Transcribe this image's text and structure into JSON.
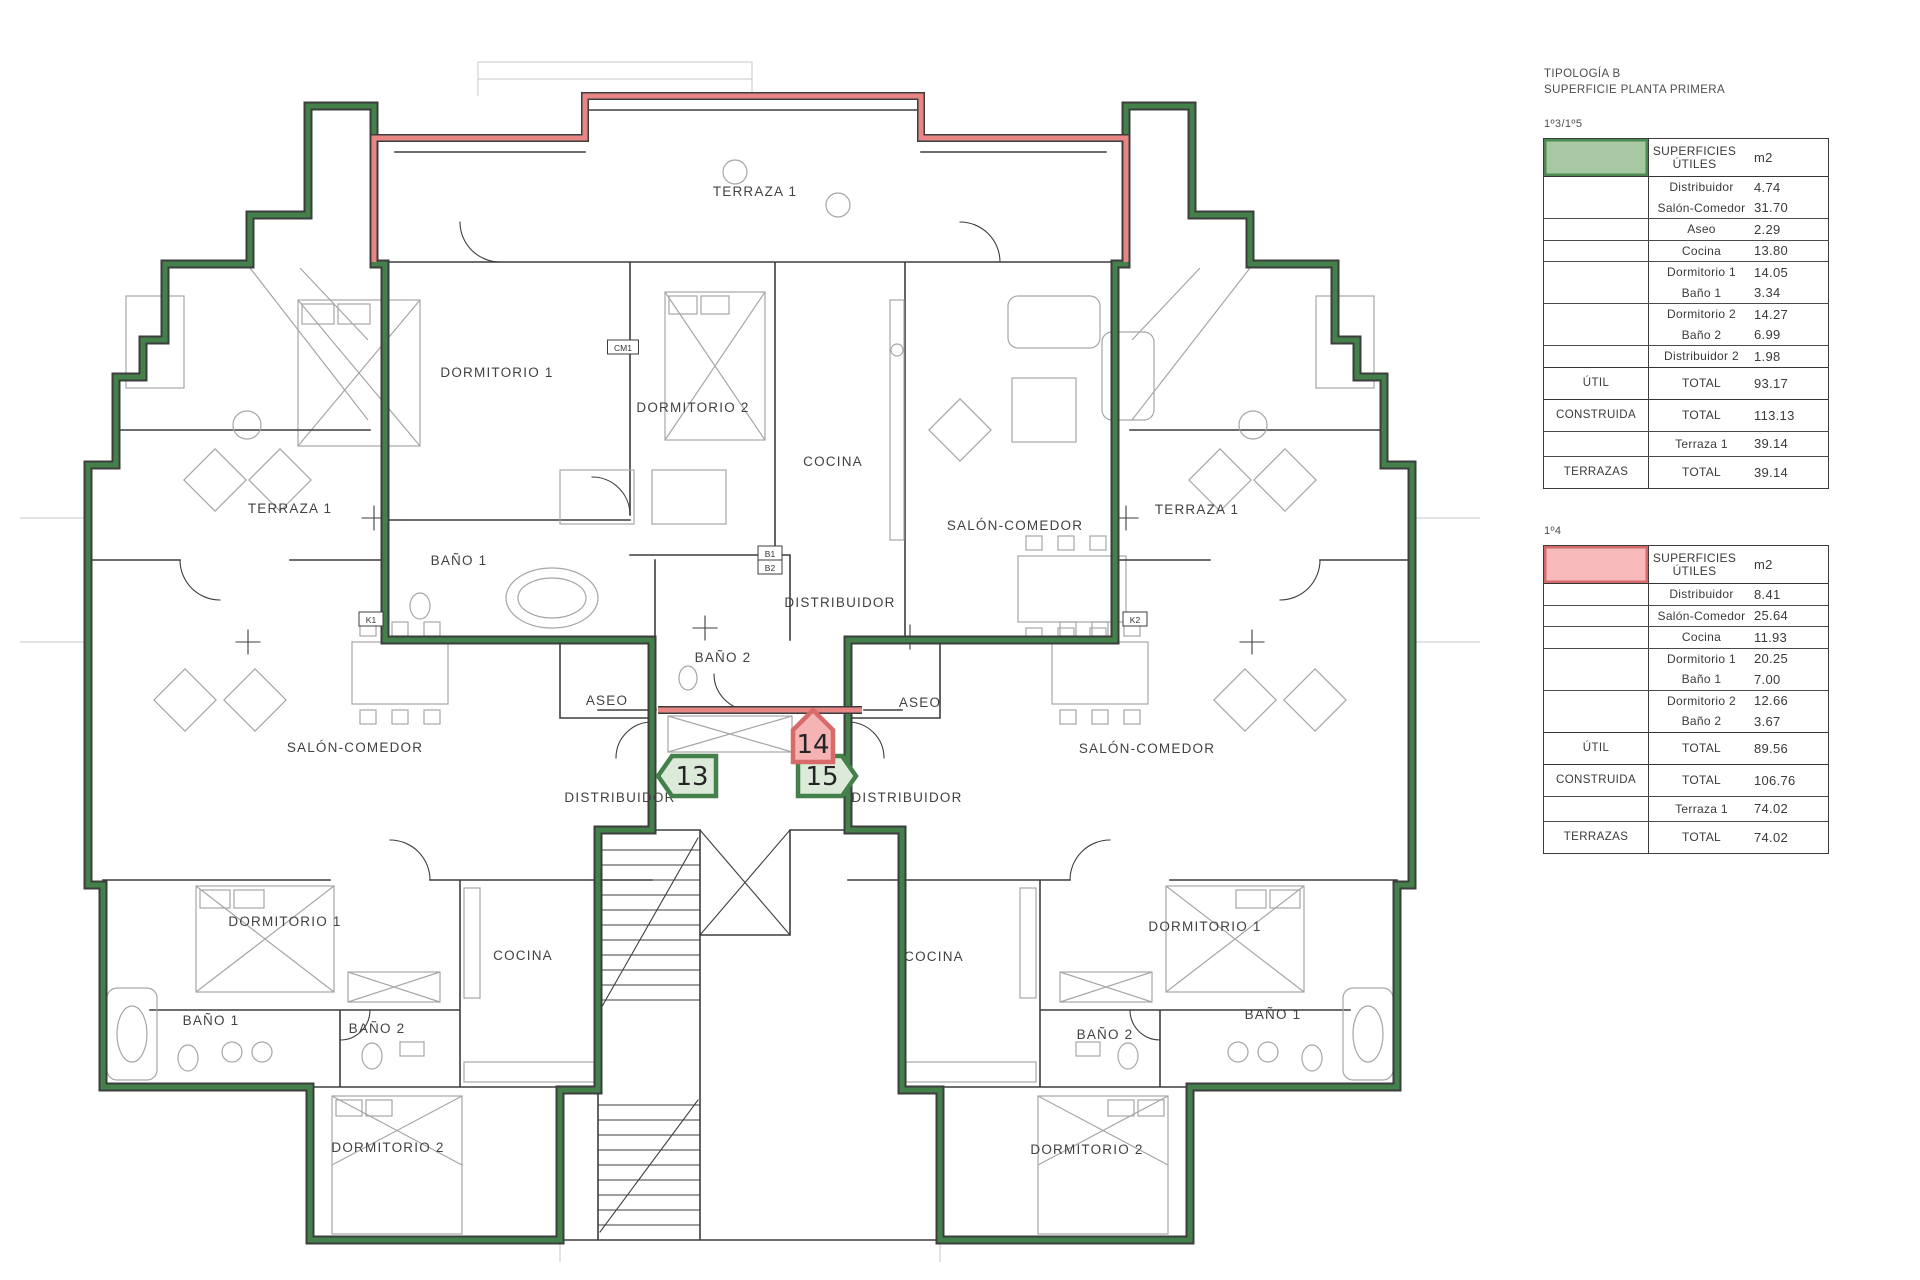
{
  "page": {
    "width": 1920,
    "height": 1280,
    "background": "#ffffff"
  },
  "header": {
    "title_line1": "TIPOLOGÍA B",
    "title_line2": "SUPERFICIE PLANTA PRIMERA"
  },
  "tables": [
    {
      "unit_label": "1º3/1º5",
      "swatch": {
        "fill": "#a7c8a3",
        "border": "#4d8a52"
      },
      "header": {
        "line1": "SUPERFICIES",
        "line2": "ÚTILES",
        "unit": "m2"
      },
      "rooms": [
        {
          "name": "Distribuidor",
          "value": "4.74"
        },
        {
          "name": "Salón-Comedor",
          "value": "31.70"
        },
        {
          "name": "Aseo",
          "value": "2.29"
        },
        {
          "name": "Cocina",
          "value": "13.80"
        },
        {
          "name": "Dormitorio 1",
          "value": "14.05"
        },
        {
          "name": "Baño 1",
          "value": "3.34"
        },
        {
          "name": "Dormitorio 2",
          "value": "14.27"
        },
        {
          "name": "Baño 2",
          "value": "6.99"
        },
        {
          "name": "Distribuidor 2",
          "value": "1.98"
        }
      ],
      "dividers_thin": [
        "Salón-Comedor",
        "Aseo",
        "Cocina",
        "Baño 1",
        "Baño 2"
      ],
      "dividers_thick": [
        "Distribuidor 2"
      ],
      "totals": [
        {
          "label": "ÚTIL",
          "name": "TOTAL",
          "value": "93.17"
        },
        {
          "label": "CONSTRUIDA",
          "name": "TOTAL",
          "value": "113.13"
        },
        {
          "label": "",
          "name": "Terraza 1",
          "value": "39.14"
        },
        {
          "label": "TERRAZAS",
          "name": "TOTAL",
          "value": "39.14"
        }
      ]
    },
    {
      "unit_label": "1º4",
      "swatch": {
        "fill": "#f7b9b9",
        "border": "#d46a6a"
      },
      "header": {
        "line1": "SUPERFICIES",
        "line2": "ÚTILES",
        "unit": "m2"
      },
      "rooms": [
        {
          "name": "Distribuidor",
          "value": "8.41"
        },
        {
          "name": "Salón-Comedor",
          "value": "25.64"
        },
        {
          "name": "Cocina",
          "value": "11.93"
        },
        {
          "name": "Dormitorio 1",
          "value": "20.25"
        },
        {
          "name": "Baño 1",
          "value": "7.00"
        },
        {
          "name": "Dormitorio 2",
          "value": "12.66"
        },
        {
          "name": "Baño 2",
          "value": "3.67"
        }
      ],
      "dividers_thin": [
        "Distribuidor",
        "Salón-Comedor",
        "Cocina",
        "Baño 1"
      ],
      "dividers_thick": [
        "Baño 2"
      ],
      "totals": [
        {
          "label": "ÚTIL",
          "name": "TOTAL",
          "value": "89.56"
        },
        {
          "label": "CONSTRUIDA",
          "name": "TOTAL",
          "value": "106.76"
        },
        {
          "label": "",
          "name": "Terraza 1",
          "value": "74.02"
        },
        {
          "label": "TERRAZAS",
          "name": "TOTAL",
          "value": "74.02"
        }
      ]
    }
  ],
  "plan": {
    "colors": {
      "wall": "#3d3d3d",
      "furniture": "#a6a6a6",
      "green": "#43804a",
      "green_badge_fill": "#dcead9",
      "pink": "#e88585",
      "pink_badge_fill": "#f5b3b3",
      "pink_badge_border": "#d96a6a"
    },
    "labels": [
      {
        "text": "TERRAZA 1",
        "x": 755,
        "y": 196
      },
      {
        "text": "DORMITORIO 1",
        "x": 497,
        "y": 377
      },
      {
        "text": "DORMITORIO 2",
        "x": 693,
        "y": 412
      },
      {
        "text": "COCINA",
        "x": 833,
        "y": 466
      },
      {
        "text": "SALÓN-COMEDOR",
        "x": 1015,
        "y": 530
      },
      {
        "text": "BAÑO 1",
        "x": 459,
        "y": 565
      },
      {
        "text": "DISTRIBUIDOR",
        "x": 840,
        "y": 607
      },
      {
        "text": "BAÑO 2",
        "x": 723,
        "y": 662
      },
      {
        "text": "TERRAZA 1",
        "x": 290,
        "y": 513
      },
      {
        "text": "ASEO",
        "x": 607,
        "y": 705
      },
      {
        "text": "SALÓN-COMEDOR",
        "x": 355,
        "y": 752
      },
      {
        "text": "DISTRIBUIDOR",
        "x": 620,
        "y": 802
      },
      {
        "text": "DORMITORIO 1",
        "x": 285,
        "y": 926
      },
      {
        "text": "COCINA",
        "x": 523,
        "y": 960
      },
      {
        "text": "BAÑO 1",
        "x": 211,
        "y": 1025
      },
      {
        "text": "BAÑO 2",
        "x": 377,
        "y": 1033
      },
      {
        "text": "DORMITORIO 2",
        "x": 388,
        "y": 1152
      },
      {
        "text": "TERRAZA 1",
        "x": 1197,
        "y": 514
      },
      {
        "text": "ASEO",
        "x": 920,
        "y": 707
      },
      {
        "text": "SALÓN-COMEDOR",
        "x": 1147,
        "y": 753
      },
      {
        "text": "DISTRIBUIDOR",
        "x": 907,
        "y": 802
      },
      {
        "text": "DORMITORIO 1",
        "x": 1205,
        "y": 931
      },
      {
        "text": "COCINA",
        "x": 934,
        "y": 961
      },
      {
        "text": "BAÑO 1",
        "x": 1273,
        "y": 1019
      },
      {
        "text": "BAÑO 2",
        "x": 1105,
        "y": 1039
      },
      {
        "text": "DORMITORIO 2",
        "x": 1087,
        "y": 1154
      }
    ],
    "badges": [
      {
        "number": "13",
        "dir": "left",
        "x": 688,
        "y": 776,
        "color": "green"
      },
      {
        "number": "15",
        "dir": "right",
        "x": 826,
        "y": 776,
        "color": "green"
      },
      {
        "number": "14",
        "dir": "up",
        "x": 813,
        "y": 742,
        "color": "pink"
      }
    ],
    "tags": [
      {
        "text": "K1",
        "x": 371,
        "y": 623
      },
      {
        "text": "K2",
        "x": 1135,
        "y": 623
      },
      {
        "text": "CM1",
        "x": 623,
        "y": 351
      },
      {
        "text": "B1",
        "x": 770,
        "y": 557
      },
      {
        "text": "B2",
        "x": 770,
        "y": 571
      }
    ]
  }
}
